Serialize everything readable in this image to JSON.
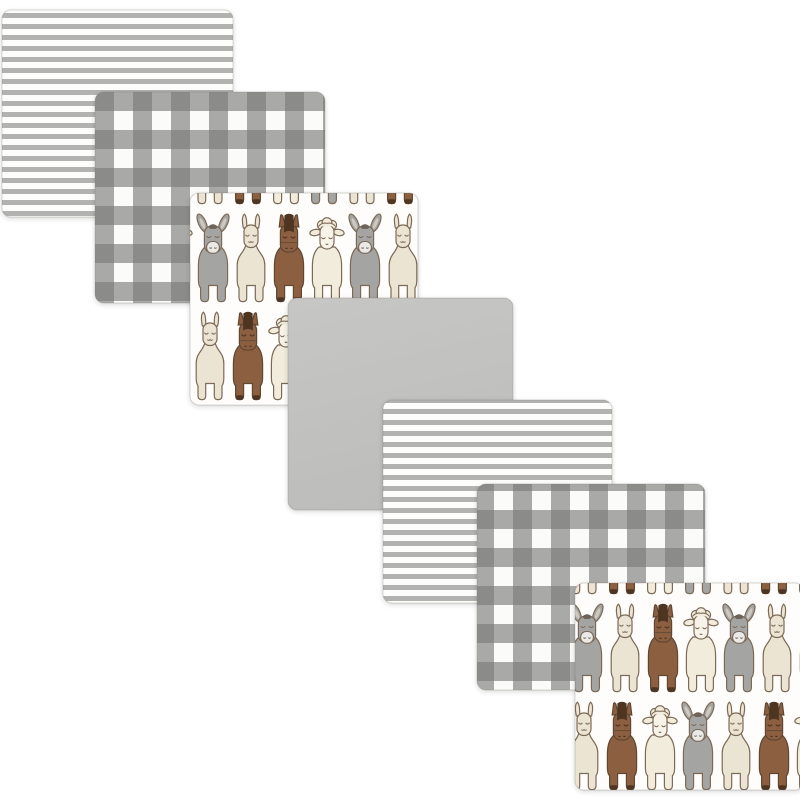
{
  "product": {
    "kind": "receiving-blanket-set",
    "piece_count": 7,
    "background_color": "#ffffff"
  },
  "pattern_styles": {
    "stripe": {
      "bg": "#fdfdfb",
      "stripe": "#b2b2b0",
      "period": 11,
      "stripe_height": 5
    },
    "check": {
      "bg": "#fbfbf9",
      "mid": "#a9a9a7",
      "dark": "#8b8b89",
      "cell": 19
    },
    "solid": {
      "fill_top": "#c6c6c4",
      "fill_bottom": "#bdbdbb",
      "edge": "#b0b0ae"
    },
    "animals": {
      "bg": "#fefdfb",
      "outline": "#7c6a57",
      "horse_outline": "#5f4633",
      "donkey": "#a4a4a2",
      "donkey_muzzle": "#e9e9e7",
      "inner_ear": "#cfc8c0",
      "tuft": "#6e6358",
      "llama": "#ebe4d2",
      "horse": "#8b5f41",
      "horse_mane": "#4e3424",
      "sheep": "#f1ecdc",
      "sheep_face": "#f7f3e8",
      "sequence": [
        "donkey",
        "llama",
        "horse",
        "sheep"
      ],
      "row2_sequence": [
        "llama",
        "horse",
        "sheep",
        "donkey"
      ],
      "spacing": 38,
      "row_spacing": 98,
      "tile_w": 152,
      "tile_h": 196
    },
    "blanket_edge": "rgba(120,115,108,0.28)",
    "shadow": "rgba(60,58,55,0.20)",
    "corner_radius": 9
  },
  "blankets": [
    {
      "name": "striped-blanket-back",
      "pattern": "stripe",
      "x": 2,
      "y": 10,
      "w": 231,
      "h": 207
    },
    {
      "name": "plaid-blanket-back",
      "pattern": "check",
      "x": 95,
      "y": 92,
      "w": 230,
      "h": 211
    },
    {
      "name": "animal-blanket-back",
      "pattern": "animalsA",
      "x": 190,
      "y": 193,
      "w": 228,
      "h": 212
    },
    {
      "name": "solid-gray-blanket",
      "pattern": "solid",
      "x": 288,
      "y": 298,
      "w": 225,
      "h": 212
    },
    {
      "name": "striped-blanket-front",
      "pattern": "stripe",
      "x": 383,
      "y": 400,
      "w": 229,
      "h": 203
    },
    {
      "name": "plaid-blanket-front",
      "pattern": "check",
      "x": 477,
      "y": 484,
      "w": 228,
      "h": 206
    },
    {
      "name": "animal-blanket-front",
      "pattern": "animalsB",
      "x": 575,
      "y": 583,
      "w": 229,
      "h": 207
    }
  ]
}
